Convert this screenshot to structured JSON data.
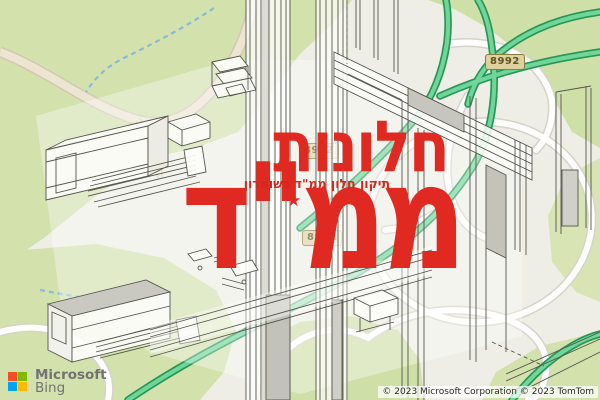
{
  "watermark": {
    "title_line1": "חלונות",
    "title_line2": "ממ\"ד",
    "tagline": "תיקון חלון ממ\"ד בשומרון",
    "star": "★",
    "accent_color": "#e02a21"
  },
  "map": {
    "badges": [
      {
        "label": "8992"
      },
      {
        "label": "8992"
      },
      {
        "label": "8992"
      }
    ],
    "colors": {
      "park_green": "#d3e1ac",
      "highway_green": "#2aa65a",
      "stream_blue": "#8ab9dd",
      "badge_fill": "#ddd1a0"
    }
  },
  "attribution": {
    "microsoft_label": "Microsoft",
    "bing_label": "Bing",
    "copyright": "© 2023 Microsoft Corporation © 2023 TomTom",
    "logo_colors": {
      "orange": "#f25022",
      "green": "#7fba00",
      "blue": "#00a4ef",
      "yellow": "#ffb900"
    }
  }
}
